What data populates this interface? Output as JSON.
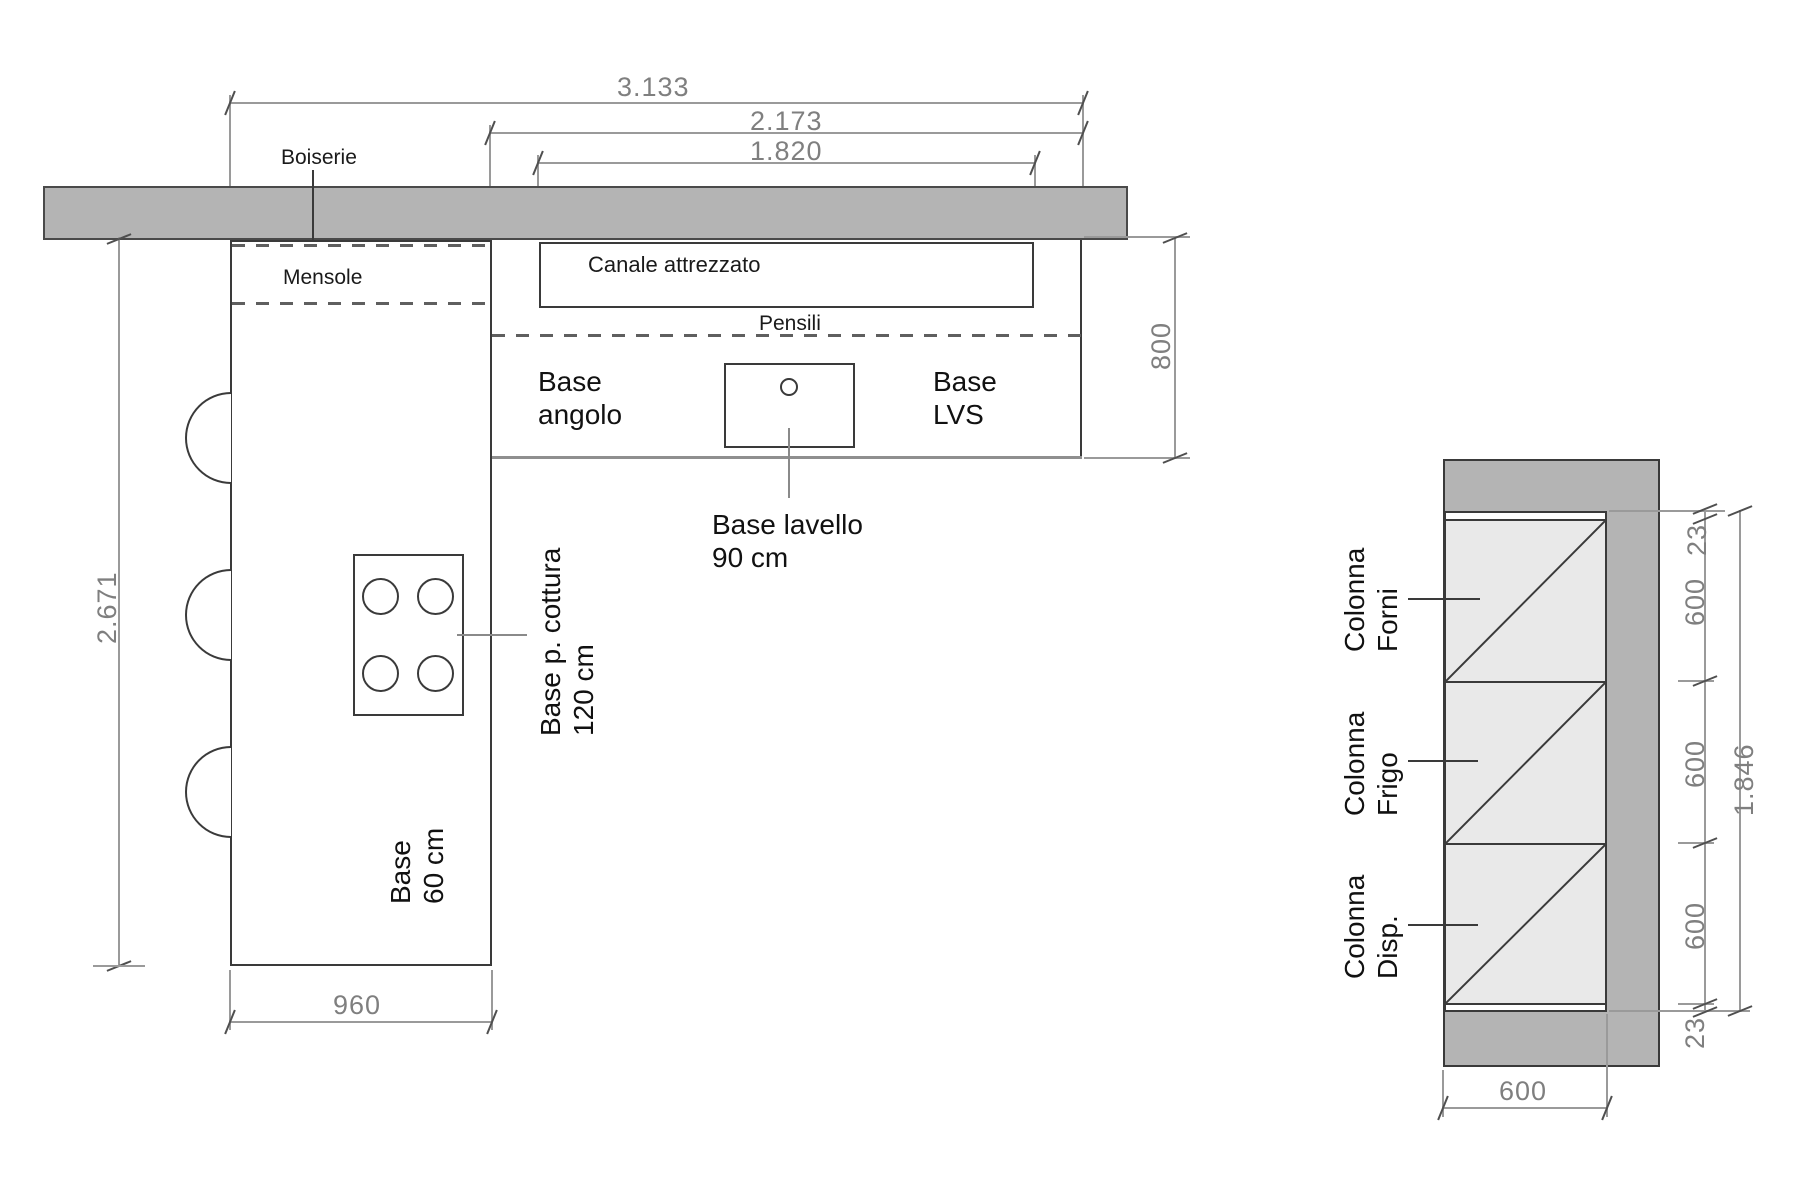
{
  "colors": {
    "wall_fill": "#b4b4b4",
    "cell_fill": "#e9e9e9",
    "object_line": "#3a3a3a",
    "dim_line": "#9a9a9a",
    "dim_text": "#7f7f7f",
    "label_text": "#1a1a1a"
  },
  "plan": {
    "wall_panel_label": "Boiserie",
    "shelves_label": "Mensole",
    "channel_label": "Canale attrezzato",
    "upper_cabinets_label": "Pensili",
    "corner_unit": {
      "line1": "Base",
      "line2": "angolo"
    },
    "lvs_unit": {
      "line1": "Base",
      "line2": "LVS"
    },
    "sink_unit": {
      "line1": "Base lavello",
      "line2": "90 cm"
    },
    "cooktop_unit": {
      "line1": "Base p. cottura",
      "line2": "120 cm"
    },
    "island_unit": {
      "line1": "Base",
      "line2": "60 cm"
    },
    "dim_total_width": "3.133",
    "dim_counter_width": "2.173",
    "dim_channel_width": "1.820",
    "dim_island_length": "2.671",
    "dim_counter_depth": "800",
    "dim_island_width": "960"
  },
  "elevation": {
    "oven_column": {
      "line1": "Colonna",
      "line2": "Forni"
    },
    "fridge_column": {
      "line1": "Colonna",
      "line2": "Frigo"
    },
    "pantry_column": {
      "line1": "Colonna",
      "line2": "Disp."
    },
    "dim_top_panel": "23",
    "dim_oven": "600",
    "dim_fridge": "600",
    "dim_pantry": "600",
    "dim_bottom_panel": "23",
    "dim_total_height": "1.846",
    "dim_width": "600"
  }
}
